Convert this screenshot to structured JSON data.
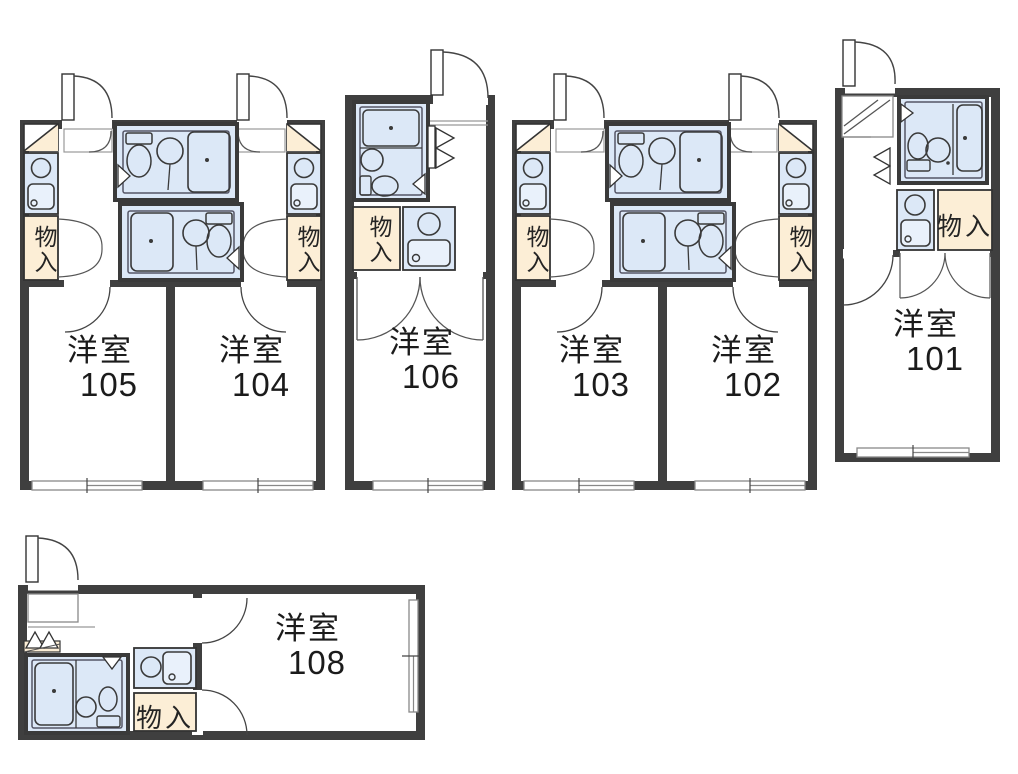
{
  "floorplan": {
    "type": "apartment-floor-plan",
    "colors": {
      "wall": "#3f3f3f",
      "bath_fill": "#dce8f7",
      "sink_fill": "#e9f1fb",
      "storage_fill": "#fceed6",
      "line": "#333333"
    },
    "units": [
      {
        "room_label": "洋室",
        "room_number": "105",
        "storage_label": "物入"
      },
      {
        "room_label": "洋室",
        "room_number": "104",
        "storage_label": "物入"
      },
      {
        "room_label": "洋室",
        "room_number": "106",
        "storage_label": "物入"
      },
      {
        "room_label": "洋室",
        "room_number": "103",
        "storage_label": "物入"
      },
      {
        "room_label": "洋室",
        "room_number": "102",
        "storage_label": "物入"
      },
      {
        "room_label": "洋室",
        "room_number": "101",
        "storage_label": "物入"
      },
      {
        "room_label": "洋室",
        "room_number": "108",
        "storage_label": "物入"
      }
    ]
  }
}
